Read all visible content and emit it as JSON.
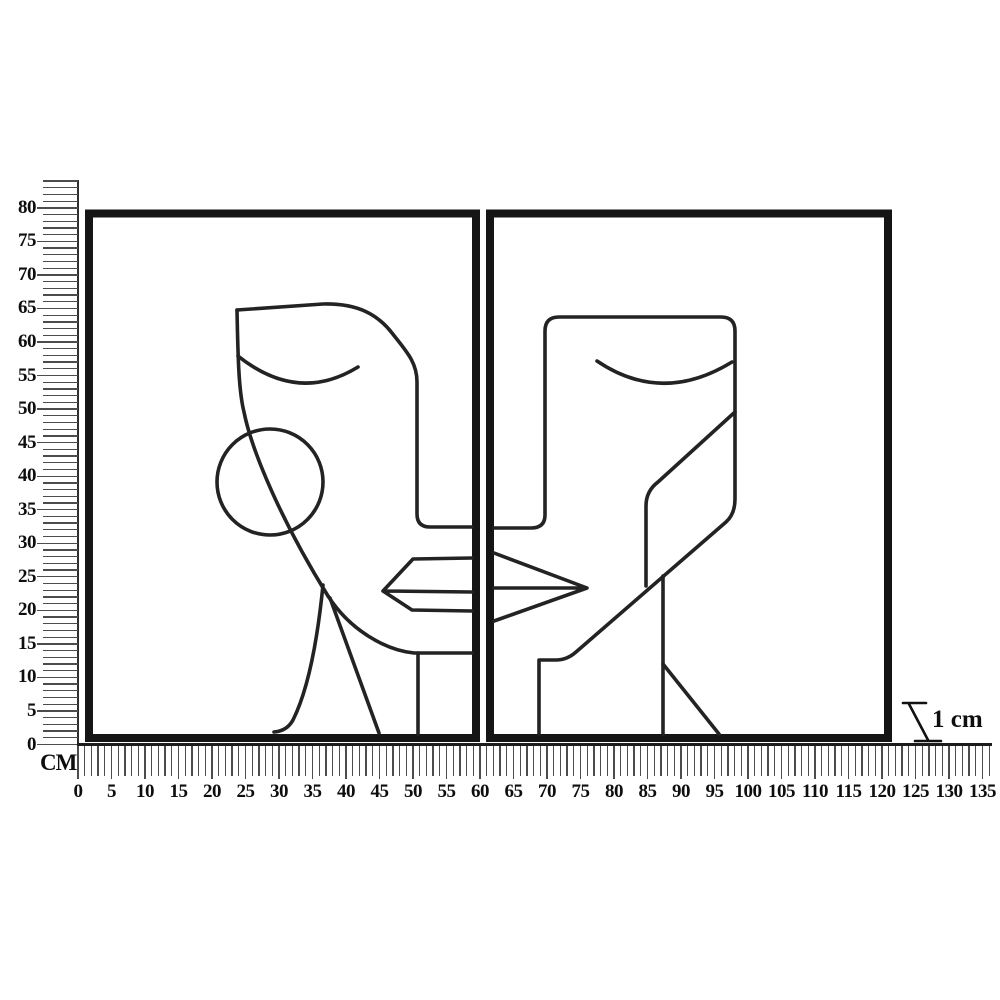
{
  "scene": {
    "background": "#ffffff",
    "unit_label": "CM",
    "depth_annotation": "1 cm",
    "frame_color": "#151515",
    "art_line_color": "#232323",
    "tick_color": "#4c4c4c",
    "label_color": "#0e0e0e"
  },
  "vertical_ruler": {
    "orientation": "vertical",
    "unit": "cm",
    "label_step": 5,
    "max_label": 80,
    "major_labels": [
      "0",
      "5",
      "10",
      "15",
      "20",
      "25",
      "30",
      "35",
      "40",
      "45",
      "50",
      "55",
      "60",
      "65",
      "70",
      "75",
      "80"
    ]
  },
  "horizontal_ruler": {
    "orientation": "horizontal",
    "unit": "cm",
    "label_step": 5,
    "max_label": 135,
    "major_labels": [
      "0",
      "5",
      "10",
      "15",
      "20",
      "25",
      "30",
      "35",
      "40",
      "45",
      "50",
      "55",
      "60",
      "65",
      "70",
      "75",
      "80",
      "85",
      "90",
      "95",
      "100",
      "105",
      "110",
      "115",
      "120",
      "125",
      "130",
      "135"
    ]
  },
  "artwork": {
    "style": "abstract cubist line-art faces",
    "panel_count": 2,
    "panels": [
      {
        "id": "left-panel",
        "content": "abstract female face with circle earring"
      },
      {
        "id": "right-panel",
        "content": "abstract angular face with geometric cheek"
      }
    ]
  }
}
